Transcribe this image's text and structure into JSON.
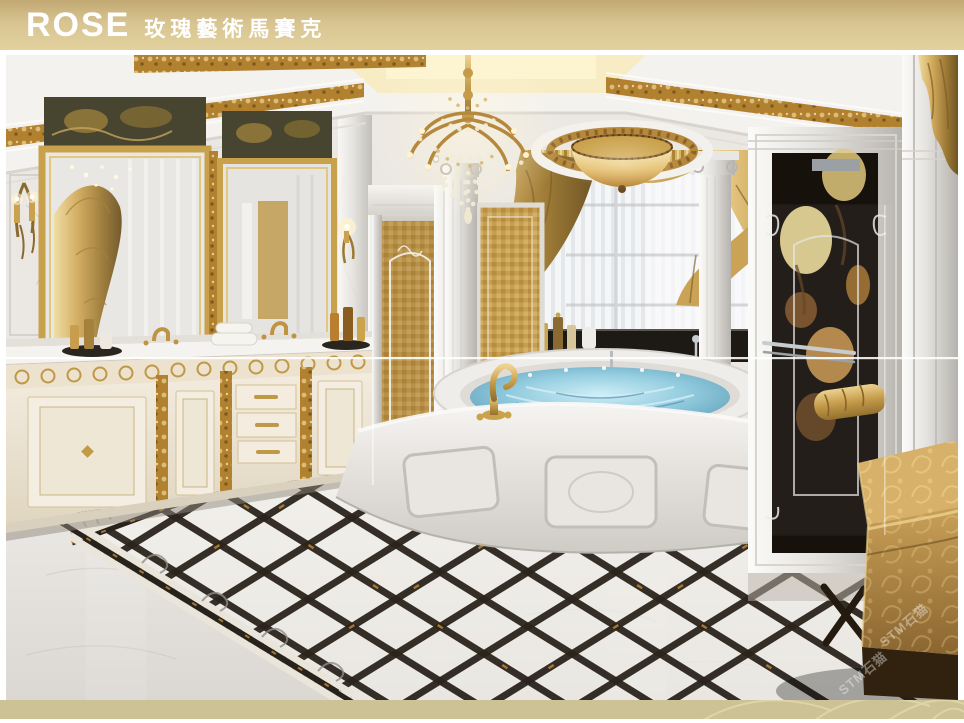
{
  "page": {
    "width": 964,
    "height": 723,
    "background": "#ffffff"
  },
  "header": {
    "logo_text": "ROSE",
    "brand_text": "玫瑰藝術馬賽克",
    "text_color": "#ffffff",
    "band_color_top": "#c2a873",
    "band_color_bottom": "#e2d19e"
  },
  "photo": {
    "description": "Luxury classical bathroom rendering with white marble, gold mosaic, crystal chandelier, oval jacuzzi and diamond-pattern marble floor",
    "divider_line": {
      "y_px": 358,
      "color": "#ffffff"
    },
    "palette": {
      "marble_light": "#f2f0ed",
      "marble_shadow": "#b9b5b0",
      "gold_ornament": "#b8873c",
      "gold_light": "#dfc07a",
      "curtain_gold": "#c9a558",
      "water_blue": "#7fc0d8",
      "black_marble": "#2b241d",
      "mosaic_amber": "#c49a4e",
      "fabric_gold": "#cfa760",
      "mural_dark": "#17110c"
    },
    "elements": [
      "ceiling-gold-bands",
      "crystal-chandelier",
      "amber-dome-ceiling-light",
      "vanity-mirrors",
      "wall-sconces",
      "marble-vanity-counter",
      "cream-gold-cabinets",
      "gold-mosaic-steam-door",
      "marble-columns",
      "gold-window-curtains",
      "oval-jacuzzi-tub",
      "gold-swan-faucet",
      "marble-tub-apron",
      "glass-shower-with-mosaic-mural",
      "gold-towel",
      "marble-right-pilasters",
      "gold-damask-ottoman",
      "black-white-diamond-floor-inlay"
    ]
  },
  "watermark": {
    "text": "STM石猫",
    "color": "rgba(255,255,255,0.38)"
  },
  "footer": {
    "band_color": "#cdc296",
    "ornament_color": "#ded4a8"
  }
}
